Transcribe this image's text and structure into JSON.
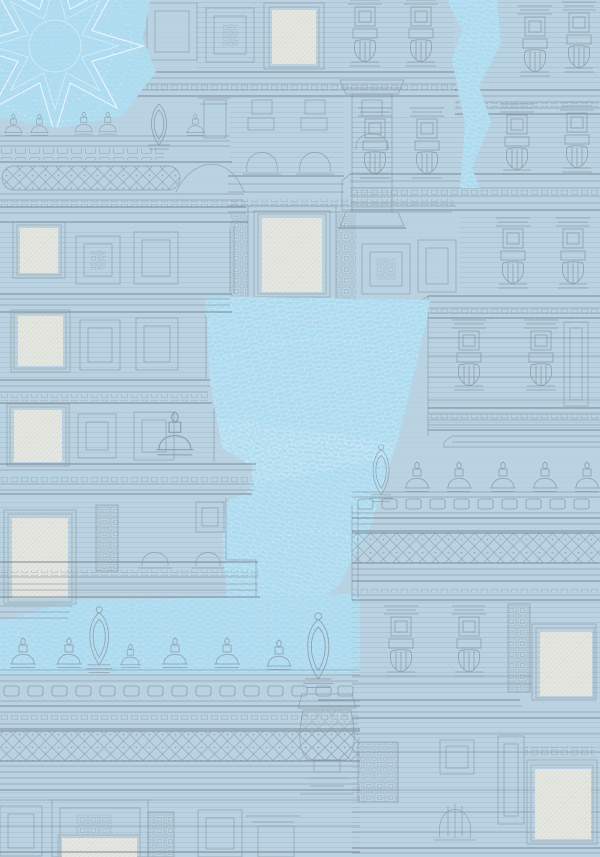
{
  "artwork": {
    "kind": "decorative line-art wallpaper pattern",
    "subject": "South Indian temple gopuram facades with cream window openings, dome and kalasha finials, lattice and meander friezes, battlement parapets and an eight-point star mandala on bright blue patches",
    "visible_text": "none"
  },
  "palette": {
    "bg": "#b9d3e2",
    "bright": "#aedcf0",
    "line": "#8a98a5",
    "line_heavy": "#7b8a97",
    "cream": "#e6e7e1",
    "cream_frame": "#aab6bb",
    "white_line": "#f3fafe"
  },
  "motifs": {
    "mandala": "eight-point star mandala",
    "dome_finial": "small dome finial (stupi)",
    "kalasha_finial": "tall kalasha finial",
    "oval_finial": "pointed oval finial",
    "lattice_frieze": "diamond lattice frieze",
    "meander_frieze": "meander key frieze",
    "window": "cream plastered window opening",
    "pilaster": "pilaster with niche and pot baluster",
    "cornice": "stepped cornice band",
    "battlement": "parapet battlement row",
    "brick_rows": "whitewashed brick rows on bright plaster patches"
  },
  "counts": {
    "windows": 9,
    "dome_finials": 16,
    "kalasha_finials": 3,
    "oval_finials": 1,
    "lattice_friezes": 3,
    "star_mandalas": 1
  }
}
